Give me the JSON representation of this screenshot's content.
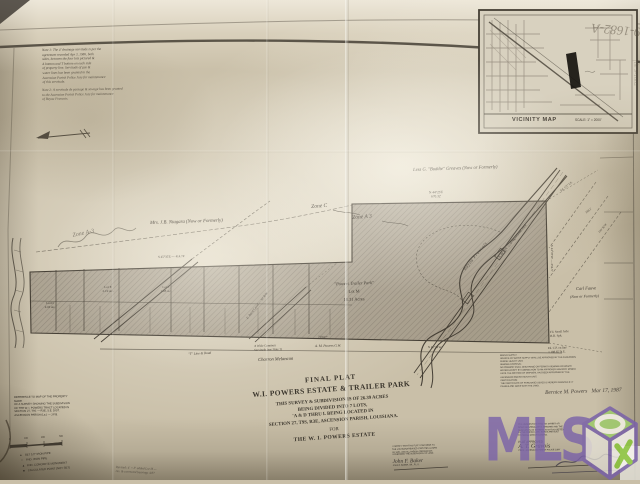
{
  "photo": {
    "corner_number": "9-1682-A",
    "edge_number": "file 9-1682"
  },
  "notes": {
    "note1": "Note 1:   The 4' drainage servitude is per the\nagreement recorded  Apr 3, 1986, both\nsides, between the four lots pictured &\nA  bottom and  T  bottom on each side\nof property line.  Servitude of gas &\nwater lines has been granted to the\nAscension Parish Police Jury for maintenance\nof this servitude.",
    "note2": "Note 2:   A servitude de passage & sewage has been granted\nto the Ascension Parish Police Jury for maintenance\nof Bayou Francois."
  },
  "vicinity_map": {
    "title": "VICINITY MAP",
    "scale": "SCALE: 1\" = 2000'"
  },
  "plat": {
    "greaves": "Less G. \"Buddie\" Greaves   (Now or Formerly)",
    "niagara": "Mrs. J.B. Niagara   (Now or Formerly)",
    "zone_c": "Zone C",
    "zone_a3": "Zone A 3",
    "zone_a3_hand": "Zone A-3",
    "trailer_park_name": "\"Powers Trailer Park\"",
    "lot_m": "Lot M",
    "lot_m_acres": "18.31 Acres",
    "bayou": "Bayou Francois",
    "railroad": "N 38°05'E — along railroad track",
    "rw": "100' R/W",
    "carl_fauve": "Carl Fauve",
    "carl_fauve_note": "(Now or Formerly)",
    "charron": "Charron Melancon",
    "servitude": "4' Wide Common\nServitude  (see Note 1)",
    "powers_gw": "A. M. Powers   G.W.",
    "road_note": "\"T\" Line & Road",
    "dim_block_top": "N 44°25'E\n670.32'",
    "dim_right_edge": "S 44°35'W — 254.5'",
    "dim_strip_top": "S 45°35'E — 414.74'",
    "dim_bottom": "719.67'",
    "dim_bottom_right": "N 45°14'W",
    "tie_axle": "Fd. Small Axle\nR.R. Spk.",
    "tie_cp": "Fd. C.P. on line\n± 188.65' N.E.",
    "tie_ip": "Fd. 1/2\" I.P.",
    "tie_ip_dist": "169.1'",
    "lot_e": "Lot E\n2.19 Ac.",
    "lot_f": "Lot F\n1.98 Ac.",
    "lot_d": "Lot D\n2.10 Ac.",
    "canal": "E. Baird Canal — 30' R/W"
  },
  "scale_bar": {
    "ticks": [
      "0",
      "100",
      "200",
      "300"
    ]
  },
  "legend": {
    "items": [
      {
        "symbol": "●",
        "label": "SET 1/2\" IRON PIPE"
      },
      {
        "symbol": "○",
        "label": "FND. IRON PIPE"
      },
      {
        "symbol": "▲",
        "label": "FND. CONCRETE MONUMENT"
      },
      {
        "symbol": "■",
        "label": "CALCULATED POINT (NOT SET)"
      }
    ]
  },
  "reference_note": "REFERENCE TO MAP OF THE PROPERTY MADE\nOF A SURVEY SHOWING THE SUBDIVISION\nOF THE W. I. POWERS TRACT LOCATED IN\nSECTION 27, T9S — R3E,  S.E. DIST.\nASCENSION PARISH  (La.)  —  J.F.B.",
  "revision_note": "Revised:  4' × 8' added Lot  M  —\nrev. & corrected bearings   4/87",
  "title_block": {
    "line1": "FINAL PLAT",
    "line2": "W.I. POWERS ESTATE & TRAILER PARK",
    "body": "THIS SURVEY & SUBDIVISION IS OF 26.39 ACRES\nBEING DIVIDED INTO 7 LOTS,\n'A & D THRU L BEING LOCATED IN\nSECTION 27, T9S, R3E, ASCENSION PARISH, LOUISIANA.",
    "for_label": "FOR",
    "client": "THE W. I. POWERS ESTATE"
  },
  "surveyor_cert": {
    "text": "I CERTIFY THAT THIS PLAT CONFORMS TO\nTHE LOUISIANA REVISED STATUTES  LA.MRS\n33: 5051, AND ALL PARISH ORDINANCES\nGOVERNING THE SUBDIVISION OF LAND.",
    "signature": "John F. Baker",
    "name": "JOHN F. BAKER, SR., P.L.S."
  },
  "approval_cert": {
    "text": "IT IS UNDERSTOOD THAT NO STREET OR\nROAD MAINTENANCE IS GRANTED AND THE\nDEDICATION OF STREETS IS NOT ACCEPTED\nBY THE PARISH UNTIL ROADS ARE BUILT\nTO PARISH SPECIFICATIONS.",
    "approved": "PLAT APPROVED",
    "signature": "A. T. Gravois",
    "title": "PRES., ASCENSION PARISH POLICE JURY"
  },
  "health_note": "WATER SUPPLY:\nSOURCE OF WATER SUPPLY SHALL BE APPROVED BY THE ASCENSION\nPARISH HEALTH UNIT.\nSEWAGE DISPOSAL:\nNO PREMISE SHALL DISCHARGE OR PERMIT A SEWAGE OR WASTE\nWATER EXCEPT BY CONNECTION TO AN APPROVED SANITARY SEWER\nUNTIL THE METHOD OF DISPOSAL HAS BEEN APPROVED BY THE\nASCENSION PARISH HEALTH UNIT.\nCERTIFICATION:\nTHE CERTIFICATE OF PURCHASE ISSUED IS HEREBY GRANTED IF IT\nPASSES AND GOES WITH THE LAND.",
  "owner_signature": {
    "name": "Bernice M. Powers",
    "date": "Mar 17, 1987"
  },
  "mls": {
    "text": "MLS",
    "purple": "#7b63a8",
    "green": "#8dc63f"
  }
}
